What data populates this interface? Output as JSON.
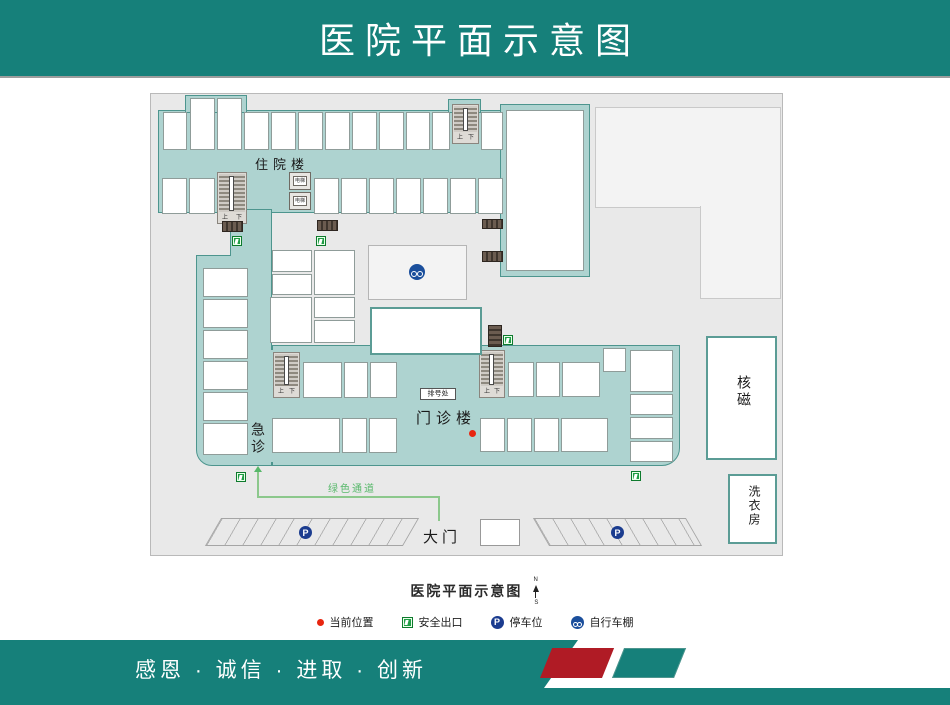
{
  "header": {
    "title": "医院平面示意图"
  },
  "plan": {
    "buildings": {
      "inpatient": "住院楼",
      "emergency": "急诊",
      "outpatient": "门诊楼",
      "mri": "核磁",
      "laundry": "洗衣房"
    },
    "labels": {
      "ticket_office": "排号处",
      "main_gate": "大门",
      "green_channel": "绿色通道",
      "elevator": "电梯",
      "stairs_up": "上",
      "stairs_down": "下",
      "parking_letter": "P"
    },
    "caption": {
      "text": "医院平面示意图",
      "compass_north": "N",
      "compass_south": "S"
    }
  },
  "legend": {
    "items": [
      {
        "icon": "current-position-dot",
        "label": "当前位置"
      },
      {
        "icon": "safety-exit-icon",
        "label": "安全出口"
      },
      {
        "icon": "parking-icon",
        "label": "停车位"
      },
      {
        "icon": "bike-shed-icon",
        "label": "自行车棚"
      }
    ]
  },
  "footer": {
    "slogan": "感恩 · 诚信 · 进取 · 创新"
  },
  "colors": {
    "brand_teal": "#16807a",
    "corridor_fill": "#aed3d0",
    "corridor_border": "#4d958e",
    "accent_red": "#b01b25",
    "exit_green": "#1f9d44",
    "parking_blue": "#1b3c8f",
    "path_green": "#8cc88c",
    "current_dot": "#e8250f"
  }
}
